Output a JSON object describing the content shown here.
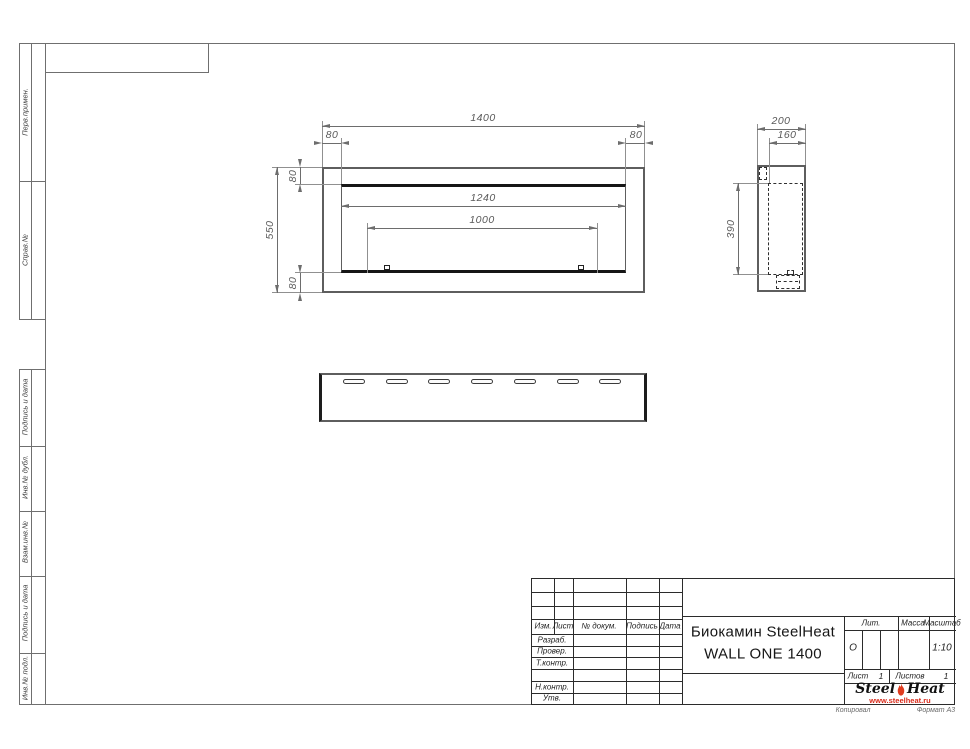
{
  "sheet": {
    "copied_note": "Копировал",
    "format_note": "Формат А3"
  },
  "margin_stamps": {
    "top": [
      {
        "label": "Перв.примен."
      },
      {
        "label": "Справ.№"
      }
    ],
    "bottom": [
      {
        "label": "Подпись и дата"
      },
      {
        "label": "Инв.№ дубл."
      },
      {
        "label": "Взам.инв.№"
      },
      {
        "label": "Подпись и дата"
      },
      {
        "label": "Инв.№ подл."
      }
    ]
  },
  "views": {
    "front": {
      "dim_width": "1400",
      "dim_left_offset": "80",
      "dim_right_offset": "80",
      "dim_height": "550",
      "dim_top_offset": "80",
      "dim_bottom_offset": "80",
      "dim_opening_width": "1240",
      "dim_burner_width": "1000"
    },
    "side": {
      "dim_depth": "200",
      "dim_inner_depth": "160",
      "dim_inner_height": "390"
    },
    "bottom": {
      "slot_count": 7
    }
  },
  "title_block": {
    "columns": {
      "izm": "Изм.",
      "list": "Лист",
      "doc": "№ докум.",
      "sign": "Подпись",
      "date": "Дата"
    },
    "rows": [
      {
        "label": "Разраб."
      },
      {
        "label": "Провер."
      },
      {
        "label": "Т.контр."
      },
      {
        "label": ""
      },
      {
        "label": "Н.контр."
      },
      {
        "label": "Утв."
      }
    ],
    "doc_title_line1": "Биокамин SteelHeat",
    "doc_title_line2": "WALL ONE 1400",
    "lit": {
      "label": "Лит.",
      "value": "О"
    },
    "mass": {
      "label": "Масса",
      "value": ""
    },
    "scale": {
      "label": "Масштаб",
      "value": "1:10"
    },
    "sheet_no": {
      "label": "Лист",
      "value": "1"
    },
    "sheets_total": {
      "label": "Листов",
      "value": "1"
    },
    "logo": {
      "word1": "Steel",
      "word2": "Heat",
      "url": "www.steelheat.ru",
      "flame_color": "#e03c1f",
      "url_color": "#d92a1a"
    }
  }
}
